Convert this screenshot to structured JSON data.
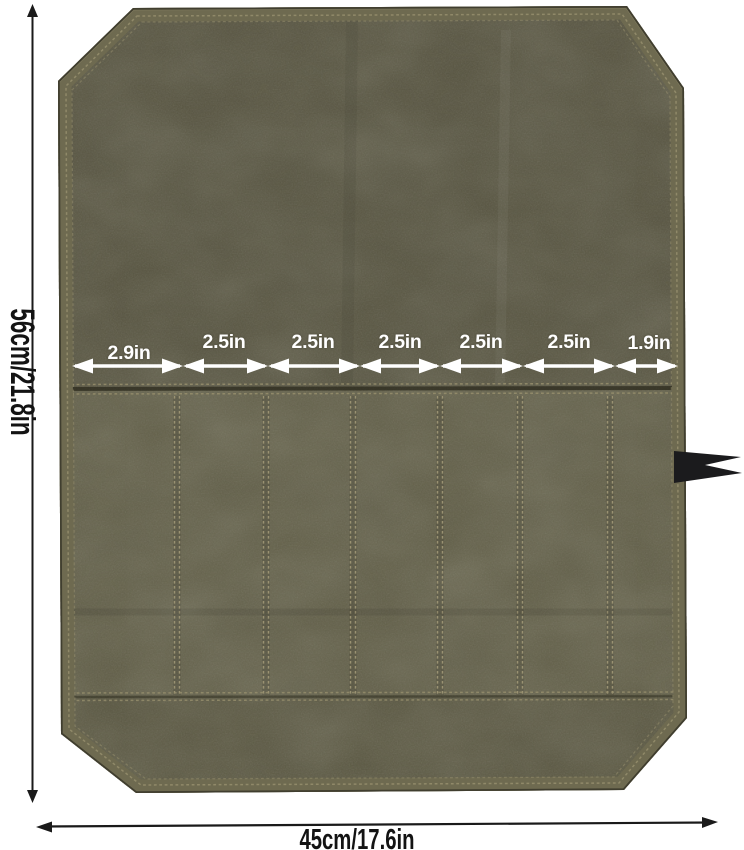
{
  "image": {
    "description": "Olive green waxed canvas tool roll organizer, opened flat, with dimension annotations",
    "background_color": "#ffffff"
  },
  "product": {
    "fabric_flap_color": "#55523e",
    "pocket_panel_color": "#605d46",
    "bottom_band_color": "#56533f",
    "binding_color": "#6e6a50",
    "edge_outline_color": "#403e2f",
    "stitch_color": "#9a9272",
    "tie_strap_color": "#1b1b1d"
  },
  "dimensions": {
    "height_label": "56cm/21.8in",
    "width_label": "45cm/17.6in",
    "overall_line_color": "#1a1a1a",
    "pocket_arrow_color": "#ffffff",
    "pocket_widths": [
      {
        "label": "2.9in"
      },
      {
        "label": "2.5in"
      },
      {
        "label": "2.5in"
      },
      {
        "label": "2.5in"
      },
      {
        "label": "2.5in"
      },
      {
        "label": "2.5in"
      },
      {
        "label": "1.9in"
      }
    ]
  }
}
